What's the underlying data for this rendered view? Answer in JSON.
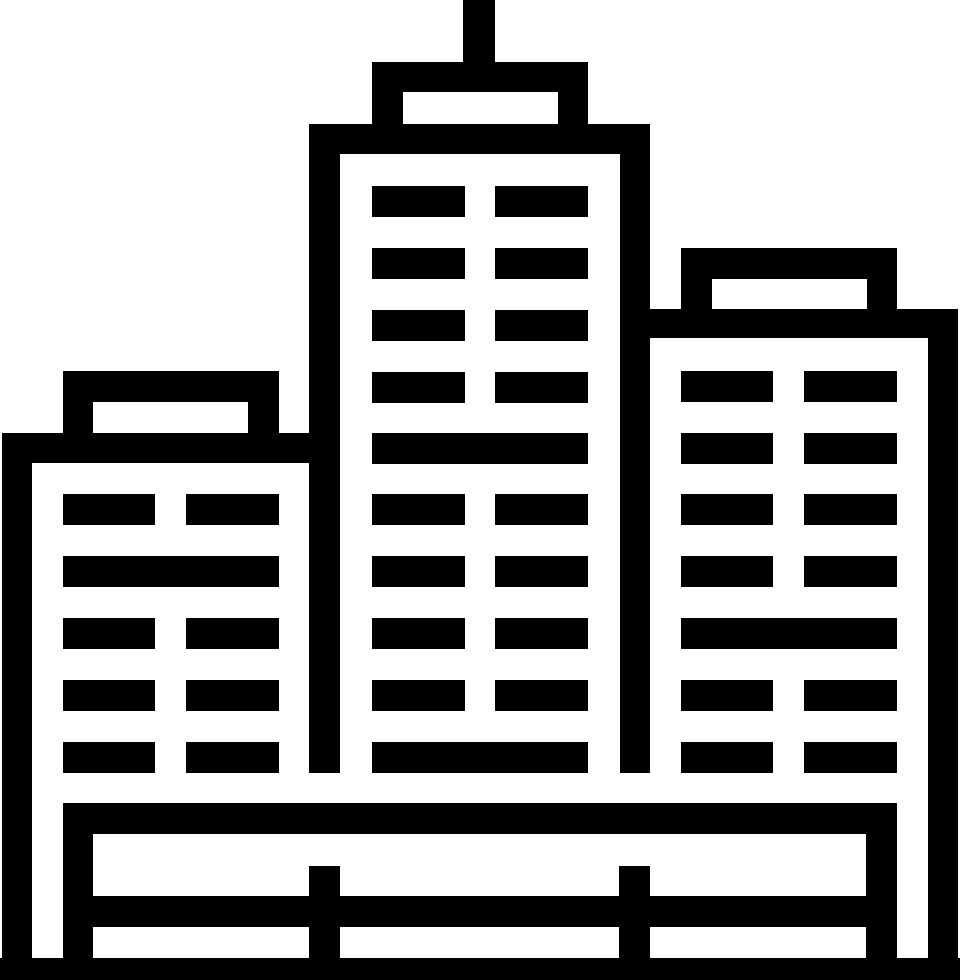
{
  "app": {
    "title": "City buildings icon"
  },
  "canvas": {
    "width": 960,
    "height": 980
  },
  "palette": {
    "fg": "#000000",
    "bg": "#ffffff"
  },
  "icon": {
    "name": "city-skyline-buildings",
    "description": "Black-and-white line pictogram: tall center skyscraper with antenna, shorter left and right towers with rooftop penthouses, window grids, and a fenced plaza base along the bottom",
    "shapes": [
      {
        "name": "antenna",
        "fill": "fg",
        "x": 463,
        "y": 0,
        "w": 32,
        "h": 70
      },
      {
        "name": "center-tower-roof-cap",
        "fill": "fg",
        "x": 372,
        "y": 62,
        "w": 216,
        "h": 62
      },
      {
        "name": "center-tower-roof-cap-window",
        "fill": "bg",
        "x": 403,
        "y": 92,
        "w": 155,
        "h": 32
      },
      {
        "name": "center-tower-frame",
        "fill": "fg",
        "x": 309,
        "y": 124,
        "w": 341,
        "h": 649
      },
      {
        "name": "center-tower-interior",
        "fill": "bg",
        "x": 340,
        "y": 154,
        "w": 280,
        "h": 619
      },
      {
        "name": "left-building-penthouse",
        "fill": "fg",
        "x": 63,
        "y": 371,
        "w": 216,
        "h": 62
      },
      {
        "name": "left-building-penthouse-window",
        "fill": "bg",
        "x": 93,
        "y": 402,
        "w": 155,
        "h": 31
      },
      {
        "name": "left-building-roof-band",
        "fill": "fg",
        "x": 2,
        "y": 433,
        "w": 338,
        "h": 30
      },
      {
        "name": "left-building-left-wall",
        "fill": "fg",
        "x": 2,
        "y": 433,
        "w": 30,
        "h": 525
      },
      {
        "name": "right-building-penthouse",
        "fill": "fg",
        "x": 681,
        "y": 248,
        "w": 216,
        "h": 61
      },
      {
        "name": "right-building-penthouse-window",
        "fill": "bg",
        "x": 712,
        "y": 279,
        "w": 155,
        "h": 30
      },
      {
        "name": "right-building-roof-band",
        "fill": "fg",
        "x": 620,
        "y": 309,
        "w": 338,
        "h": 29
      },
      {
        "name": "right-building-right-wall",
        "fill": "fg",
        "x": 928,
        "y": 309,
        "w": 30,
        "h": 649
      },
      {
        "name": "center-tower-window-r1-left",
        "fill": "fg",
        "x": 372,
        "y": 186,
        "w": 93,
        "h": 31
      },
      {
        "name": "center-tower-window-r1-right",
        "fill": "fg",
        "x": 495,
        "y": 186,
        "w": 93,
        "h": 31
      },
      {
        "name": "center-tower-window-r2-left",
        "fill": "fg",
        "x": 372,
        "y": 248,
        "w": 93,
        "h": 31
      },
      {
        "name": "center-tower-window-r2-right",
        "fill": "fg",
        "x": 495,
        "y": 248,
        "w": 93,
        "h": 31
      },
      {
        "name": "center-tower-window-r3-left",
        "fill": "fg",
        "x": 372,
        "y": 310,
        "w": 93,
        "h": 31
      },
      {
        "name": "center-tower-window-r3-right",
        "fill": "fg",
        "x": 495,
        "y": 310,
        "w": 93,
        "h": 31
      },
      {
        "name": "center-tower-window-r4-left",
        "fill": "fg",
        "x": 372,
        "y": 372,
        "w": 93,
        "h": 31
      },
      {
        "name": "center-tower-window-r4-right",
        "fill": "fg",
        "x": 495,
        "y": 372,
        "w": 93,
        "h": 31
      },
      {
        "name": "center-tower-window-r5-full",
        "fill": "fg",
        "x": 372,
        "y": 433,
        "w": 216,
        "h": 31
      },
      {
        "name": "center-tower-window-r6-left",
        "fill": "fg",
        "x": 372,
        "y": 494,
        "w": 93,
        "h": 31
      },
      {
        "name": "center-tower-window-r6-right",
        "fill": "fg",
        "x": 495,
        "y": 494,
        "w": 93,
        "h": 31
      },
      {
        "name": "center-tower-window-r7-left",
        "fill": "fg",
        "x": 372,
        "y": 556,
        "w": 93,
        "h": 31
      },
      {
        "name": "center-tower-window-r7-right",
        "fill": "fg",
        "x": 495,
        "y": 556,
        "w": 93,
        "h": 31
      },
      {
        "name": "center-tower-window-r8-left",
        "fill": "fg",
        "x": 372,
        "y": 618,
        "w": 93,
        "h": 31
      },
      {
        "name": "center-tower-window-r8-right",
        "fill": "fg",
        "x": 495,
        "y": 618,
        "w": 93,
        "h": 31
      },
      {
        "name": "center-tower-window-r9-left",
        "fill": "fg",
        "x": 372,
        "y": 680,
        "w": 93,
        "h": 31
      },
      {
        "name": "center-tower-window-r9-right",
        "fill": "fg",
        "x": 495,
        "y": 680,
        "w": 93,
        "h": 31
      },
      {
        "name": "center-tower-window-r10-full",
        "fill": "fg",
        "x": 372,
        "y": 742,
        "w": 216,
        "h": 31
      },
      {
        "name": "left-building-window-r1-left",
        "fill": "fg",
        "x": 63,
        "y": 494,
        "w": 92,
        "h": 31
      },
      {
        "name": "left-building-window-r1-right",
        "fill": "fg",
        "x": 186,
        "y": 494,
        "w": 93,
        "h": 31
      },
      {
        "name": "left-building-window-r2-full",
        "fill": "fg",
        "x": 63,
        "y": 556,
        "w": 216,
        "h": 31
      },
      {
        "name": "left-building-window-r3-left",
        "fill": "fg",
        "x": 63,
        "y": 618,
        "w": 92,
        "h": 31
      },
      {
        "name": "left-building-window-r3-right",
        "fill": "fg",
        "x": 186,
        "y": 618,
        "w": 93,
        "h": 31
      },
      {
        "name": "left-building-window-r4-left",
        "fill": "fg",
        "x": 63,
        "y": 680,
        "w": 92,
        "h": 31
      },
      {
        "name": "left-building-window-r4-right",
        "fill": "fg",
        "x": 186,
        "y": 680,
        "w": 93,
        "h": 31
      },
      {
        "name": "left-building-window-r5-left",
        "fill": "fg",
        "x": 63,
        "y": 742,
        "w": 92,
        "h": 31
      },
      {
        "name": "left-building-window-r5-right",
        "fill": "fg",
        "x": 186,
        "y": 742,
        "w": 93,
        "h": 31
      },
      {
        "name": "right-building-window-r1-left",
        "fill": "fg",
        "x": 681,
        "y": 371,
        "w": 92,
        "h": 31
      },
      {
        "name": "right-building-window-r1-right",
        "fill": "fg",
        "x": 804,
        "y": 371,
        "w": 93,
        "h": 31
      },
      {
        "name": "right-building-window-r2-left",
        "fill": "fg",
        "x": 681,
        "y": 433,
        "w": 92,
        "h": 31
      },
      {
        "name": "right-building-window-r2-right",
        "fill": "fg",
        "x": 804,
        "y": 433,
        "w": 93,
        "h": 31
      },
      {
        "name": "right-building-window-r3-left",
        "fill": "fg",
        "x": 681,
        "y": 494,
        "w": 92,
        "h": 31
      },
      {
        "name": "right-building-window-r3-right",
        "fill": "fg",
        "x": 804,
        "y": 494,
        "w": 93,
        "h": 31
      },
      {
        "name": "right-building-window-r4-left",
        "fill": "fg",
        "x": 681,
        "y": 556,
        "w": 92,
        "h": 31
      },
      {
        "name": "right-building-window-r4-right",
        "fill": "fg",
        "x": 804,
        "y": 556,
        "w": 93,
        "h": 31
      },
      {
        "name": "right-building-window-r5-full",
        "fill": "fg",
        "x": 681,
        "y": 618,
        "w": 216,
        "h": 31
      },
      {
        "name": "right-building-window-r6-left",
        "fill": "fg",
        "x": 681,
        "y": 680,
        "w": 92,
        "h": 31
      },
      {
        "name": "right-building-window-r6-right",
        "fill": "fg",
        "x": 804,
        "y": 680,
        "w": 93,
        "h": 31
      },
      {
        "name": "right-building-window-r7-left",
        "fill": "fg",
        "x": 681,
        "y": 742,
        "w": 92,
        "h": 31
      },
      {
        "name": "right-building-window-r7-right",
        "fill": "fg",
        "x": 804,
        "y": 742,
        "w": 93,
        "h": 31
      },
      {
        "name": "plaza-deck-band",
        "fill": "fg",
        "x": 63,
        "y": 803,
        "w": 834,
        "h": 31
      },
      {
        "name": "fence-post-left",
        "fill": "fg",
        "x": 63,
        "y": 803,
        "w": 30,
        "h": 155
      },
      {
        "name": "fence-post-mid-left",
        "fill": "fg",
        "x": 309,
        "y": 866,
        "w": 31,
        "h": 92
      },
      {
        "name": "fence-post-mid-right",
        "fill": "fg",
        "x": 619,
        "y": 866,
        "w": 31,
        "h": 92
      },
      {
        "name": "fence-post-right",
        "fill": "fg",
        "x": 866,
        "y": 803,
        "w": 31,
        "h": 155
      },
      {
        "name": "fence-rail",
        "fill": "fg",
        "x": 63,
        "y": 896,
        "w": 834,
        "h": 31
      },
      {
        "name": "ground-band",
        "fill": "fg",
        "x": 0,
        "y": 958,
        "w": 960,
        "h": 22
      }
    ]
  }
}
